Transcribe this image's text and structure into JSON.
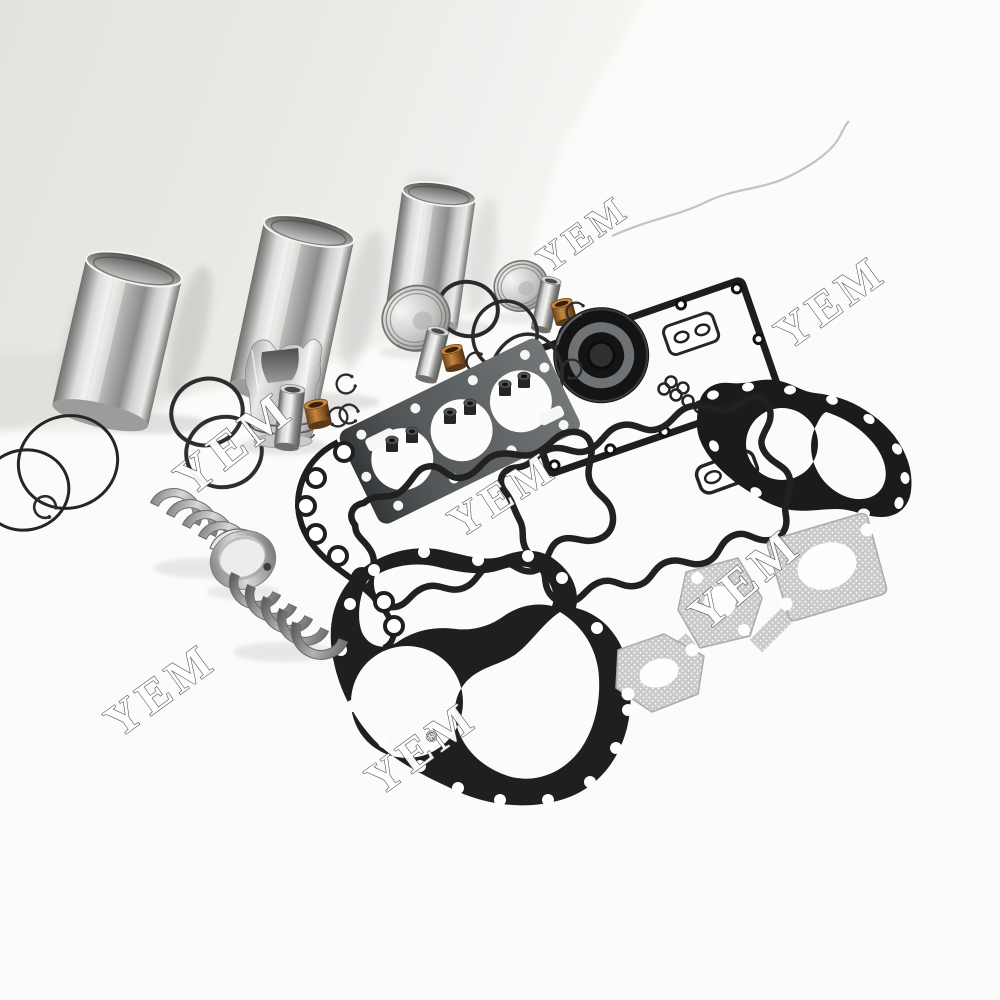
{
  "watermark": {
    "text": "YEM",
    "registered_mark": "®"
  },
  "palette": {
    "wall": "#e6e4e1",
    "floor": "#fbfbf9",
    "chrome_highlight": "#f1f1ef",
    "chrome_shadow": "#6f6f6d",
    "gasket_black": "#1f1f1f",
    "head_gasket": "#45494b",
    "manifold_gray": "#c7cac7",
    "bronze": "#a9712f",
    "oil_seal_black": "#141414"
  }
}
